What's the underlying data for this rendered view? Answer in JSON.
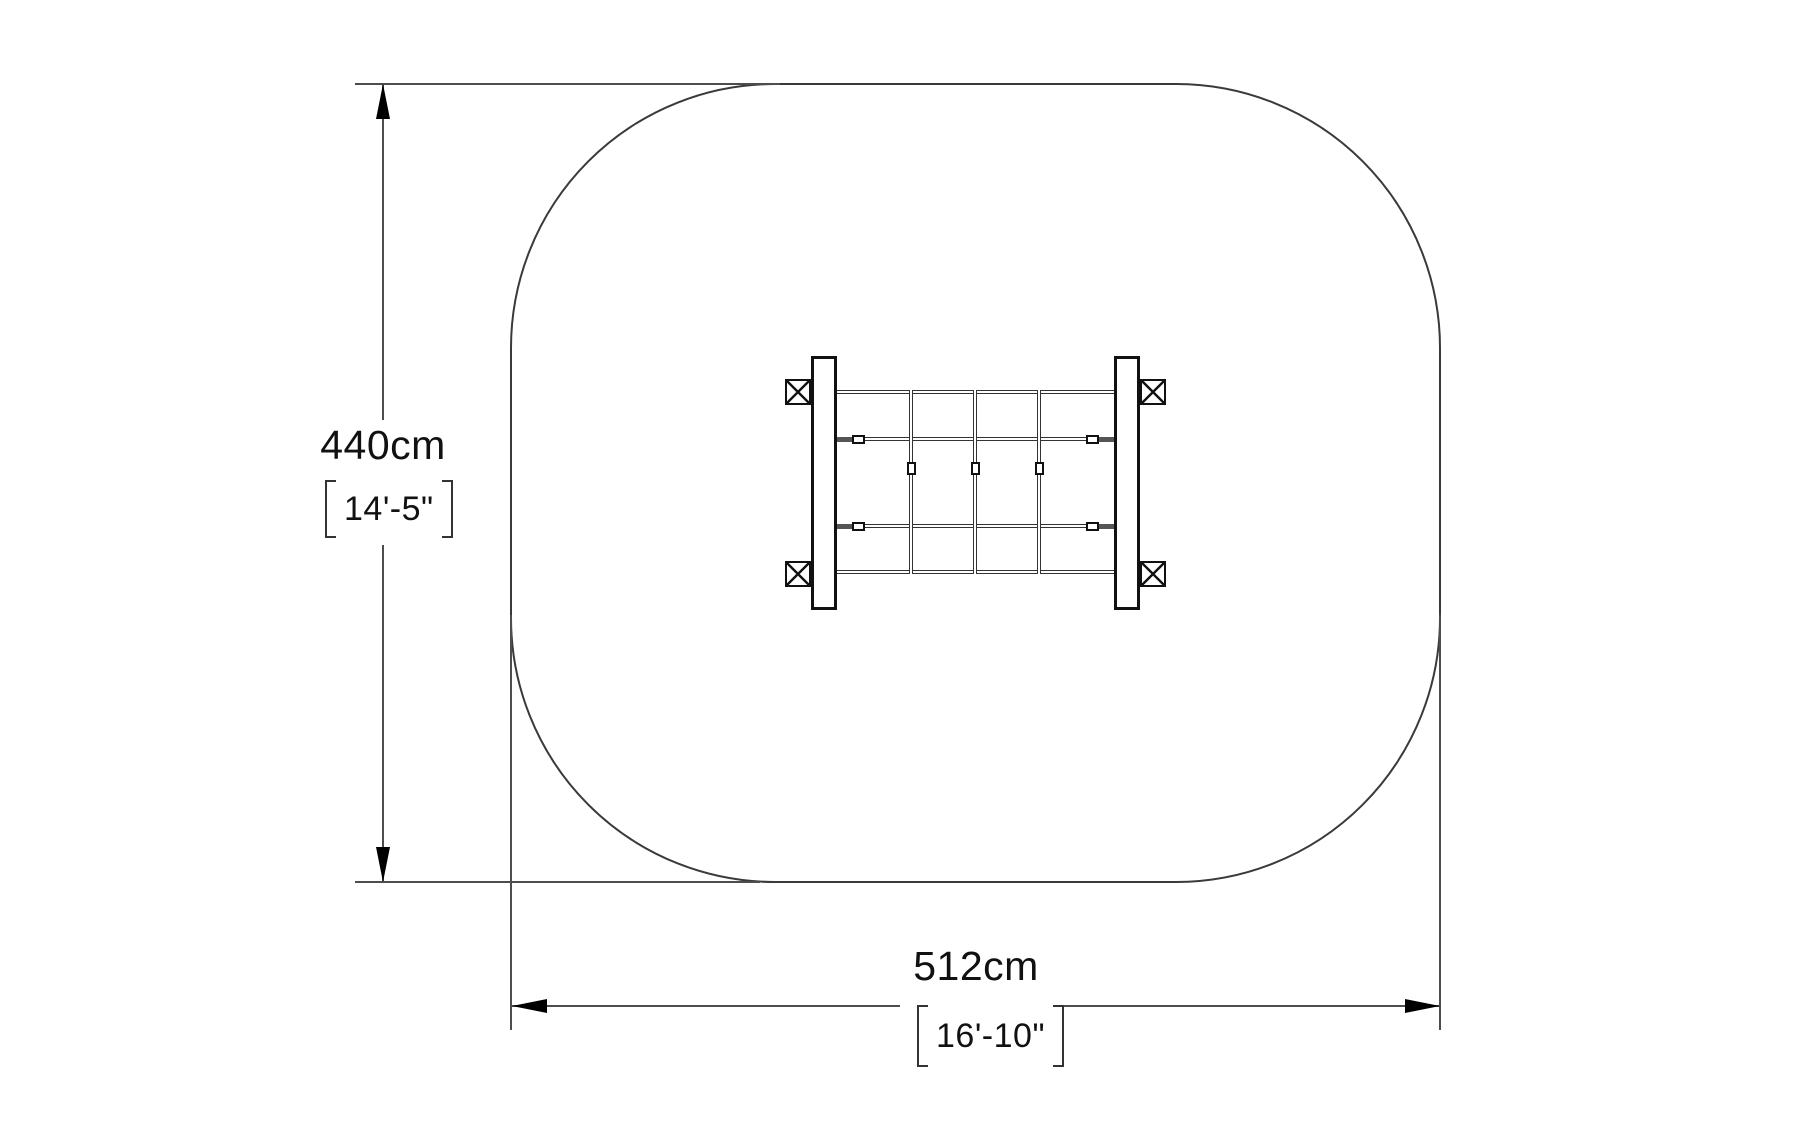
{
  "drawing": {
    "view": "plan-view-dimension-drawing",
    "dimensions": {
      "height": {
        "metric": "440cm",
        "imperial": "14'-5\""
      },
      "width": {
        "metric": "512cm",
        "imperial": "16'-10\""
      }
    }
  },
  "colors": {
    "background": "#ffffff",
    "safety_zone_outline": "#3a3a3a",
    "dimension_line": "#4d4d4d",
    "arrow": "#000000",
    "equipment_stroke": "#111111",
    "rope": "#333333",
    "text": "#111111"
  }
}
